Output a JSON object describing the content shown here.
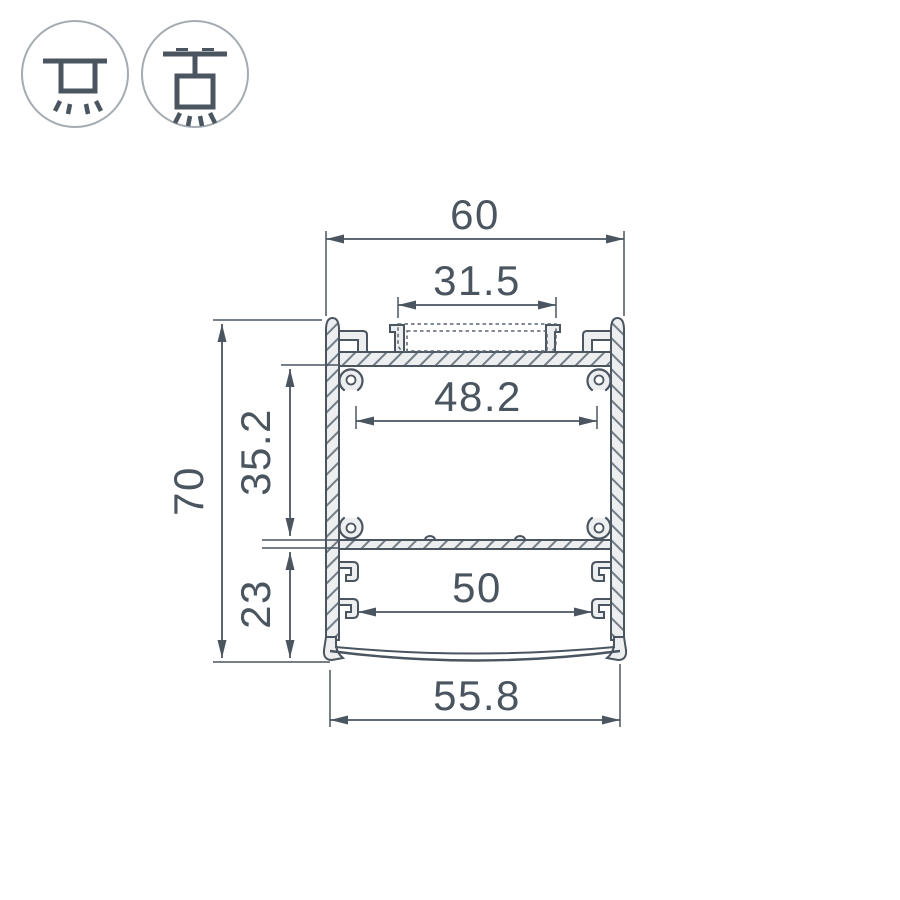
{
  "colors": {
    "line": "#4a5560",
    "metal_fill": "#edeef0",
    "icon_ring": "#a4abb1"
  },
  "icons": [
    {
      "name": "surface-mount-icon"
    },
    {
      "name": "pendant-mount-icon"
    }
  ],
  "drawing": {
    "dims": {
      "overall_width": "60",
      "cover_width": "31.5",
      "upper_inner_width": "48.2",
      "overall_height": "70",
      "upper_section_height": "35.2",
      "lower_section_height": "23",
      "lower_inner_width": "50",
      "diffuser_width": "55.8"
    }
  }
}
